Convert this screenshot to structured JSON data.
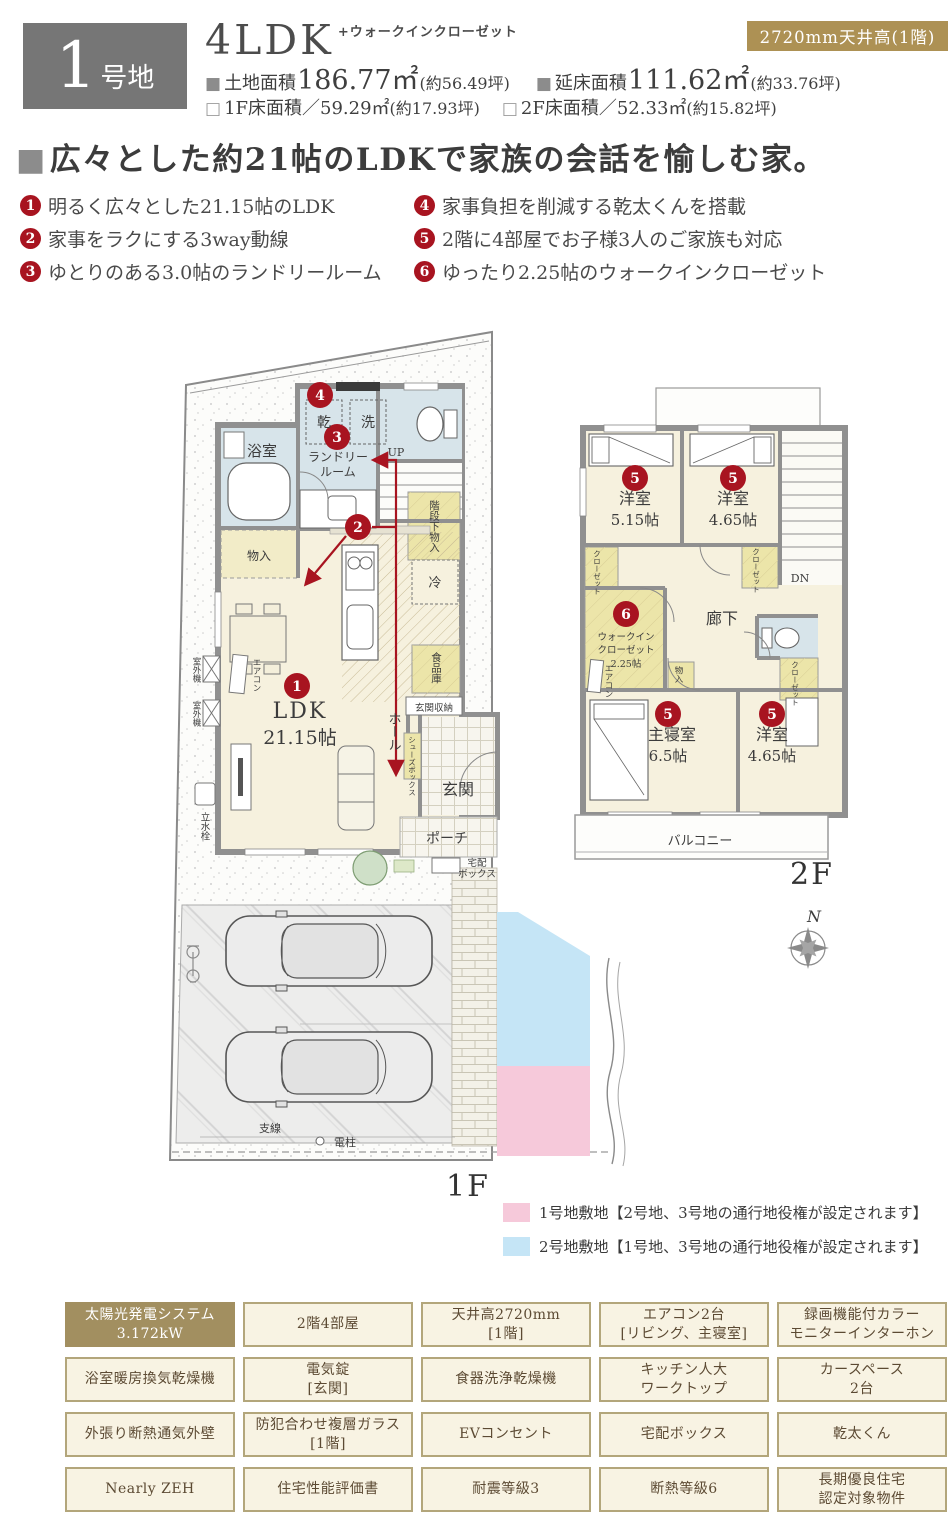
{
  "colors": {
    "accent_gold": "#ad9154",
    "plot_gray": "#767676",
    "badge_red": "#a81420",
    "plan_cream": "#f6f1de",
    "plan_blue": "#d7e4ea",
    "plan_yellow": "#ece5a9",
    "legend_pink": "#f6c9da",
    "legend_blue": "#c5e5f6"
  },
  "header": {
    "plot_num": "1",
    "plot_suffix": "号地",
    "layout_type": "4LDK",
    "layout_note": "+ウォークインクローゼット",
    "ceiling_badge": "2720mm天井高(1階)",
    "land_label": "土地面積",
    "land_value": "186.77㎡",
    "land_tsubo": "(約56.49坪)",
    "total_label": "延床面積",
    "total_value": "111.62㎡",
    "total_tsubo": "(約33.76坪)",
    "f1_label": "1F床面積／",
    "f1_value": "59.29㎡",
    "f1_tsubo": "(約17.93坪)",
    "f2_label": "2F床面積／",
    "f2_value": "52.33㎡",
    "f2_tsubo": "(約15.82坪)"
  },
  "headline": {
    "marker": "■",
    "text": "広々とした約21帖のLDKで家族の会話を愉しむ家。"
  },
  "features": [
    {
      "n": "1",
      "t": "明るく広々とした21.15帖のLDK"
    },
    {
      "n": "2",
      "t": "家事をラクにする3way動線"
    },
    {
      "n": "3",
      "t": "ゆとりのある3.0帖のランドリールーム"
    },
    {
      "n": "4",
      "t": "家事負担を削減する乾太くんを搭載"
    },
    {
      "n": "5",
      "t": "2階に4部屋でお子様3人のご家族も対応"
    },
    {
      "n": "6",
      "t": "ゆったり2.25帖のウォークインクローゼット"
    }
  ],
  "plan1f": {
    "bath": "浴室",
    "dryer": "乾",
    "washer": "洗",
    "laundry1": "ランドリー",
    "laundry2": "ルーム",
    "up": "UP",
    "stair_storage": "階段下物入",
    "storage": "物入",
    "fridge": "冷",
    "ldk": "LDK",
    "ldk_size": "21.15帖",
    "pantry": "食品庫",
    "entry_storage": "玄関収納",
    "hall": "ホール",
    "shoebox": "シューズボックス",
    "entrance": "玄関",
    "porch": "ポーチ",
    "delivery1": "宅配",
    "delivery2": "ボックス",
    "aircon": "エアコン",
    "outdoor1": "室外機",
    "outdoor2": "室外機",
    "faucet": "立水栓",
    "wire": "支線",
    "pole": "電柱",
    "floor_label": "1F"
  },
  "plan2f": {
    "room1": "洋室",
    "room1_size": "5.15帖",
    "room2": "洋室",
    "room2_size": "4.65帖",
    "closet1": "クローゼット",
    "closet2": "クローゼット",
    "closet3": "クローゼット",
    "wic1": "ウォークイン",
    "wic2": "クローゼット",
    "wic3": "2.25帖",
    "storage": "物入",
    "corridor": "廊下",
    "dn": "DN",
    "master": "主寝室",
    "master_size": "6.5帖",
    "room3": "洋室",
    "room3_size": "4.65帖",
    "balcony": "バルコニー",
    "aircon": "エアコン",
    "floor_label": "2F",
    "compass_n": "N"
  },
  "legend": {
    "items": [
      {
        "text": "1号地敷地【2号地、3号地の通行地役権が設定されます】"
      },
      {
        "text": "2号地敷地【1号地、3号地の通行地役権が設定されます】"
      }
    ]
  },
  "specs": {
    "cells": [
      {
        "l1": "太陽光発電システム",
        "l2": "3.172kW"
      },
      {
        "l1": "2階4部屋",
        "l2": ""
      },
      {
        "l1": "天井高2720mm",
        "l2": "[1階]"
      },
      {
        "l1": "エアコン2台",
        "l2": "[リビング、主寝室]"
      },
      {
        "l1": "録画機能付カラー",
        "l2": "モニターインターホン"
      },
      {
        "l1": "浴室暖房換気乾燥機",
        "l2": ""
      },
      {
        "l1": "電気錠",
        "l2": "[玄関]"
      },
      {
        "l1": "食器洗浄乾燥機",
        "l2": ""
      },
      {
        "l1": "キッチン人大",
        "l2": "ワークトップ"
      },
      {
        "l1": "カースペース",
        "l2": "2台"
      },
      {
        "l1": "外張り断熱通気外壁",
        "l2": ""
      },
      {
        "l1": "防犯合わせ複層ガラス",
        "l2": "[1階]"
      },
      {
        "l1": "EVコンセント",
        "l2": ""
      },
      {
        "l1": "宅配ボックス",
        "l2": ""
      },
      {
        "l1": "乾太くん",
        "l2": ""
      },
      {
        "l1": "Nearly ZEH",
        "l2": ""
      },
      {
        "l1": "住宅性能評価書",
        "l2": ""
      },
      {
        "l1": "耐震等級3",
        "l2": ""
      },
      {
        "l1": "断熱等級6",
        "l2": ""
      },
      {
        "l1": "長期優良住宅",
        "l2": "認定対象物件"
      }
    ]
  }
}
